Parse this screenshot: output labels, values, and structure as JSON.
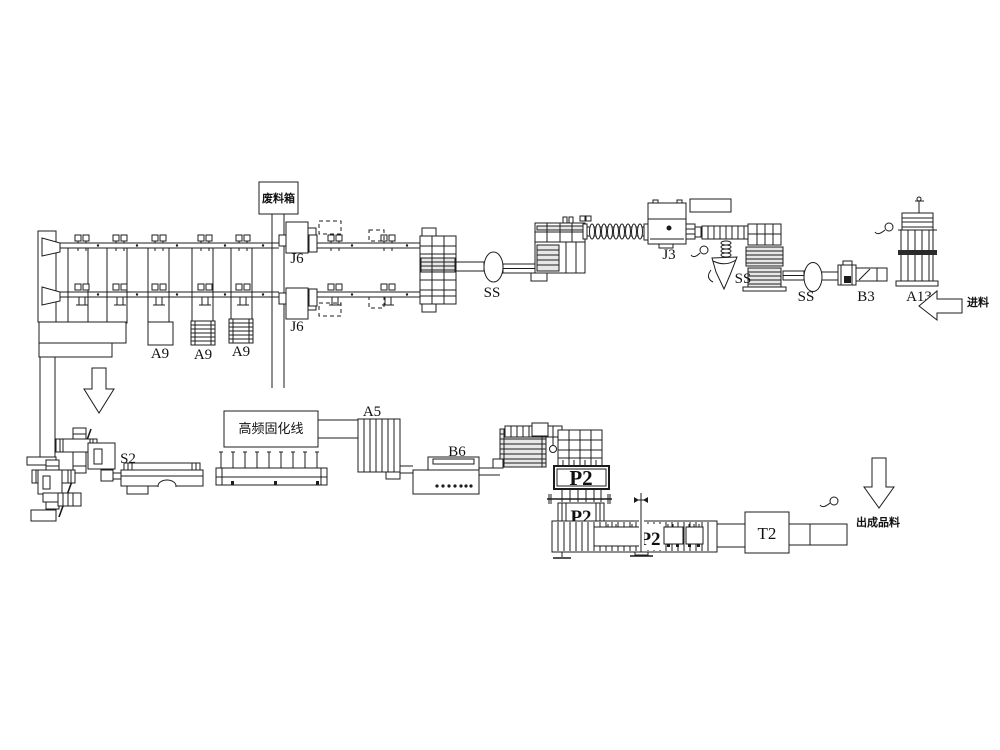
{
  "diagram": {
    "background": "#ffffff",
    "line_color": "#1c1c1c",
    "labels": {
      "waste_box": "废料箱",
      "j6_top": "J6",
      "j6_bottom": "J6",
      "a9_1": "A9",
      "a9_2": "A9",
      "a9_3": "A9",
      "ss_oval_left": "SS",
      "ss_funnel": "SS",
      "ss_oval_right": "SS",
      "j3": "J3",
      "b3": "B3",
      "a13": "A13",
      "feed_in": "进料",
      "s2": "S2",
      "curing_line": "高频固化线",
      "a5": "A5",
      "b6": "B6",
      "p2_press": "P2",
      "p2_lower": "P2",
      "p2_conveyor": "P2",
      "t2": "T2",
      "product_out": "出成品料"
    }
  }
}
